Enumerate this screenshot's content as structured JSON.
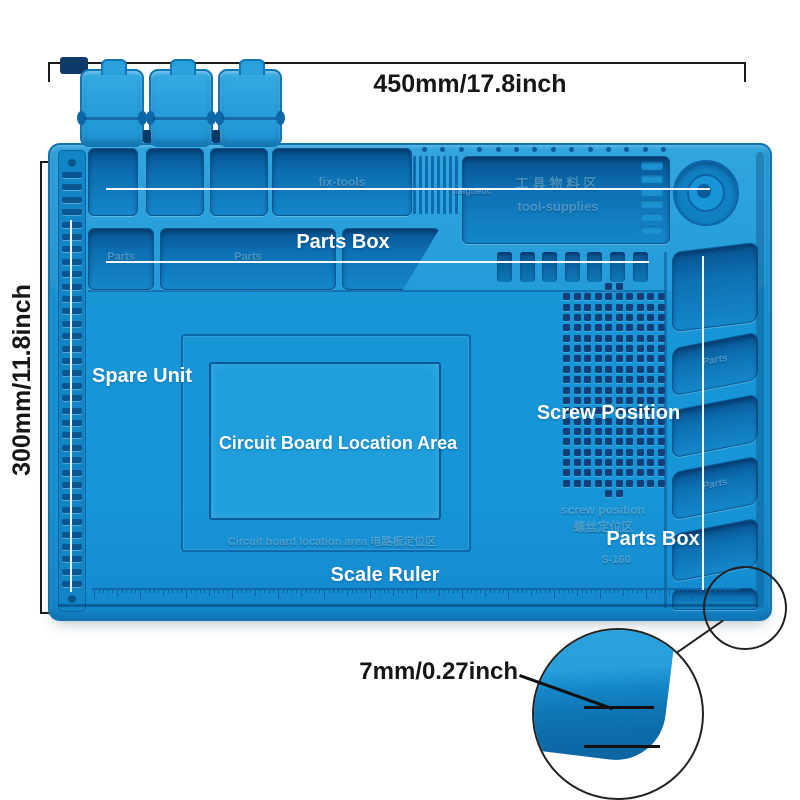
{
  "annotations": {
    "width": "450mm/17.8inch",
    "height": "300mm/11.8inch",
    "thickness": "7mm/0.27inch"
  },
  "labels": {
    "parts_box_top": "Parts Box",
    "spare_unit": "Spare Unit",
    "circuit_area": "Circuit Board Location Area",
    "screw_position": "Screw Position",
    "parts_box_right": "Parts Box",
    "scale_ruler": "Scale Ruler"
  },
  "molded": {
    "fix_tools": "fix-tools",
    "magnetic": "magnetic",
    "tool_supplies_cn": "工具物料区",
    "tool_supplies_en": "tool-supplies",
    "parts_cell_a": "Parts",
    "parts_cell_b": "Parts",
    "parts_under_dish": "Parts",
    "right_cell_a": "Parts",
    "right_cell_b": "Parts",
    "screw_position_en": "screw position",
    "screw_position_cn": "螺丝定位区",
    "model": "S-160",
    "circuit_line": "Circuit board location area  电路板定位区"
  },
  "colors": {
    "mat_blue": "#1795d6",
    "recess_blue": "#0a5c9e",
    "screw_hole_navy": "#123f78",
    "label_white": "#ffffff",
    "annotation_black": "#1a1a1a"
  }
}
